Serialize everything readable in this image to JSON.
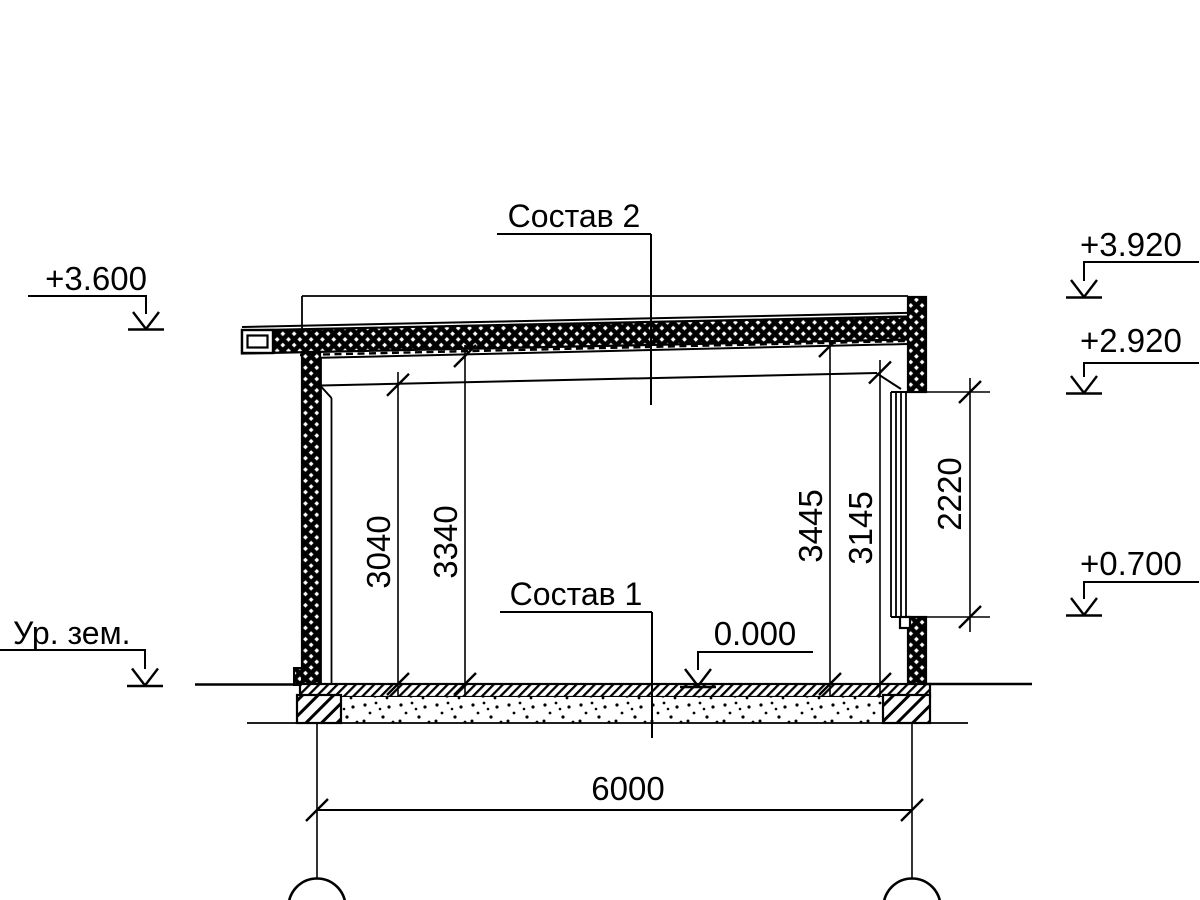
{
  "drawing": {
    "type": "architectural-section",
    "colors": {
      "line": "#000000",
      "background": "#ffffff"
    },
    "labels": {
      "composition2": "Состав 2",
      "composition1": "Состав 1",
      "ground_level": "Ур. зем."
    },
    "elevations": {
      "zero": "0.000",
      "roof_low": "+3.600",
      "parapet": "+3.920",
      "beam": "+2.920",
      "sill": "+0.700"
    },
    "dimensions": {
      "span": "6000",
      "clear_height_left": "3040",
      "deck_height_left": "3340",
      "deck_height_right": "3445",
      "clear_height_right": "3145",
      "opening_height": "2220"
    }
  }
}
